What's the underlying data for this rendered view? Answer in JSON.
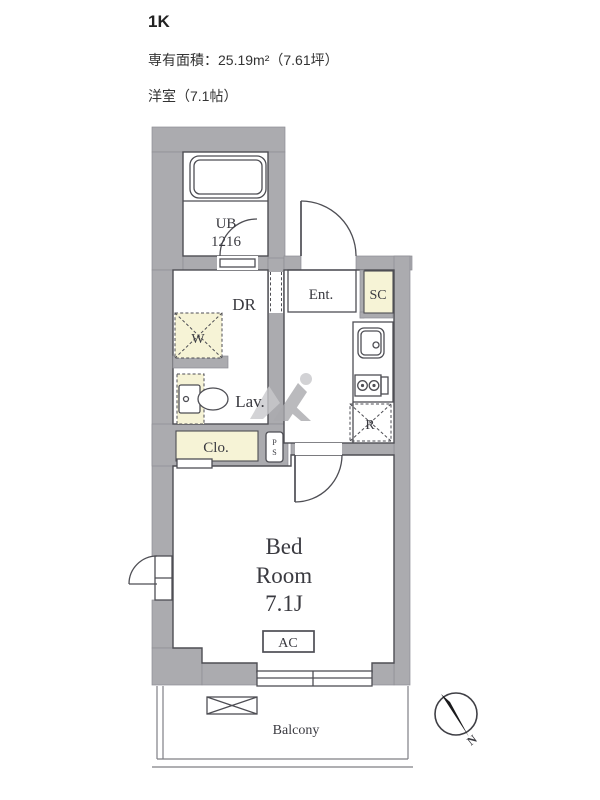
{
  "css_vars": {
    "wall": "#ababaf",
    "accent": "#f6f3d6",
    "line": "#4e4e54"
  },
  "header": {
    "plan_type": "1K",
    "area": "専有面積：25.19m²（7.61坪）",
    "room": "洋室（7.1帖）"
  },
  "floorplan": {
    "unit_bath": {
      "label": "UB",
      "size": "1216"
    },
    "dressing_room": "DR",
    "entrance": "Ent.",
    "shoe_closet": "SC",
    "washing_machine": "W",
    "lavatory": "Lav.",
    "refrigerator": "R",
    "closet": "Clo.",
    "pipe_space": {
      "line1": "P",
      "line2": "S"
    },
    "bedroom": {
      "line1": "Bed",
      "line2": "Room",
      "line3": "7.1J"
    },
    "air_conditioner": "AC",
    "balcony": "Balcony",
    "compass": {
      "north": "N"
    }
  }
}
